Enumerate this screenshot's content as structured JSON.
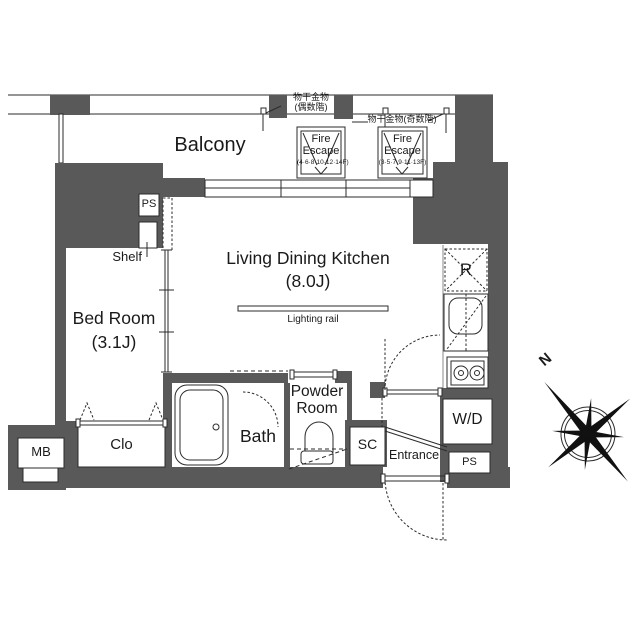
{
  "colors": {
    "wall": "#595959",
    "line": "#2b2b2b",
    "text": "#1a1a1a",
    "background": "#ffffff"
  },
  "rooms": {
    "balcony": {
      "label": "Balcony"
    },
    "ldk": {
      "label": "Living Dining Kitchen",
      "size": "(8.0J)"
    },
    "bedroom": {
      "label": "Bed Room",
      "size": "(3.1J)"
    },
    "bath": {
      "label": "Bath"
    },
    "powder_room": {
      "line1": "Powder",
      "line2": "Room"
    },
    "entrance": {
      "label": "Entrance"
    },
    "closet": {
      "label": "Clo"
    }
  },
  "fixtures": {
    "shelf": {
      "label": "Shelf"
    },
    "pipe_space_top": {
      "label": "PS"
    },
    "pipe_space_bottom": {
      "label": "PS"
    },
    "meter_box": {
      "label": "MB"
    },
    "shoe_closet": {
      "label": "SC"
    },
    "washer_dryer": {
      "label": "W/D"
    },
    "refrigerator": {
      "label": "R"
    },
    "lighting_rail": {
      "label": "Lighting rail"
    }
  },
  "annotations": {
    "laundry_hardware_even": {
      "line1": "物干金物",
      "line2": "(偶数階)"
    },
    "laundry_hardware_odd": {
      "label": "物干金物(奇数階)"
    },
    "fire_escape_left": {
      "line1": "Fire",
      "line2": "Escape",
      "floors": "(4·6·8·10·12·14F)"
    },
    "fire_escape_right": {
      "line1": "Fire",
      "line2": "Escape",
      "floors": "(3·5·7·9·11·13F)"
    },
    "compass": {
      "north": "N"
    }
  }
}
